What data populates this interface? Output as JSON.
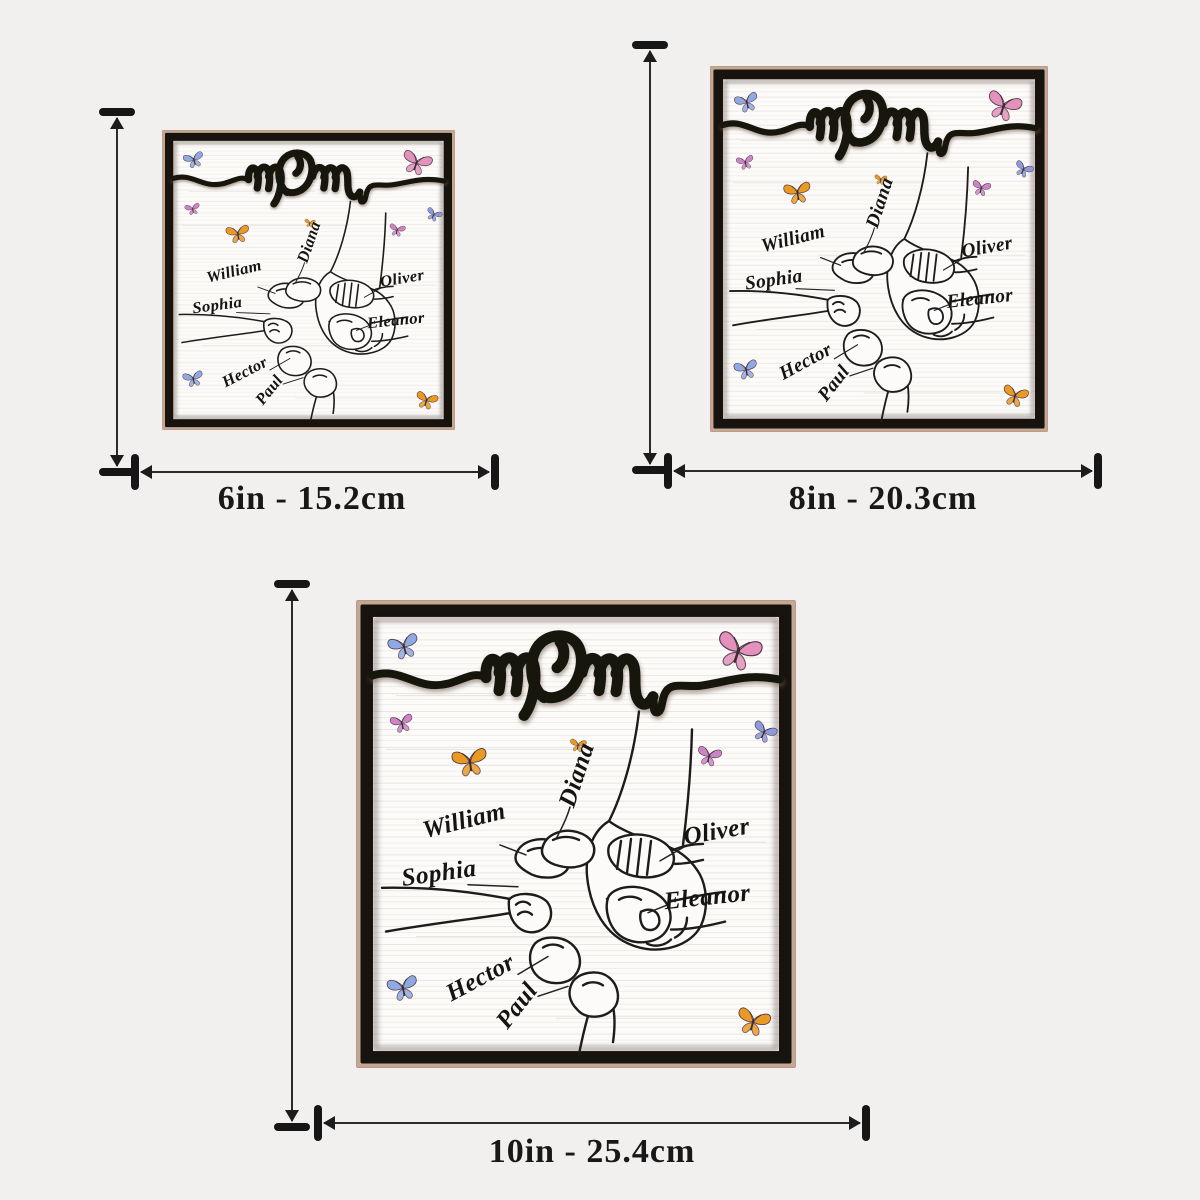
{
  "page": {
    "background_color": "#f1f0ee"
  },
  "product": {
    "title_word": "mom",
    "names": [
      "Diana",
      "William",
      "Sophia",
      "Oliver",
      "Eleanor",
      "Hector",
      "Paul"
    ],
    "art_elements": [
      "mom-hand-holding-children-hands line art",
      "butterflies",
      "wood plaque with black frame"
    ]
  },
  "variants": [
    {
      "size_label": "6in - 15.2cm"
    },
    {
      "size_label": "8in - 20.3cm"
    },
    {
      "size_label": "10in - 25.4cm"
    }
  ],
  "colors": {
    "frame_black": "#17130e",
    "wood_edge_tan": "#c5a violet",
    "wood_edge": "#c5a794",
    "plaque_face": "#fcfbf9",
    "line_art": "#1d1c1b",
    "butterfly_blue": "#8fa9e2",
    "butterfly_pink": "#e492bb",
    "butterfly_magenta": "#cd84c6",
    "butterfly_orange": "#eb9a21",
    "butterfly_periwinkle": "#8b9ade",
    "measure_ink": "#1c1c1c"
  }
}
